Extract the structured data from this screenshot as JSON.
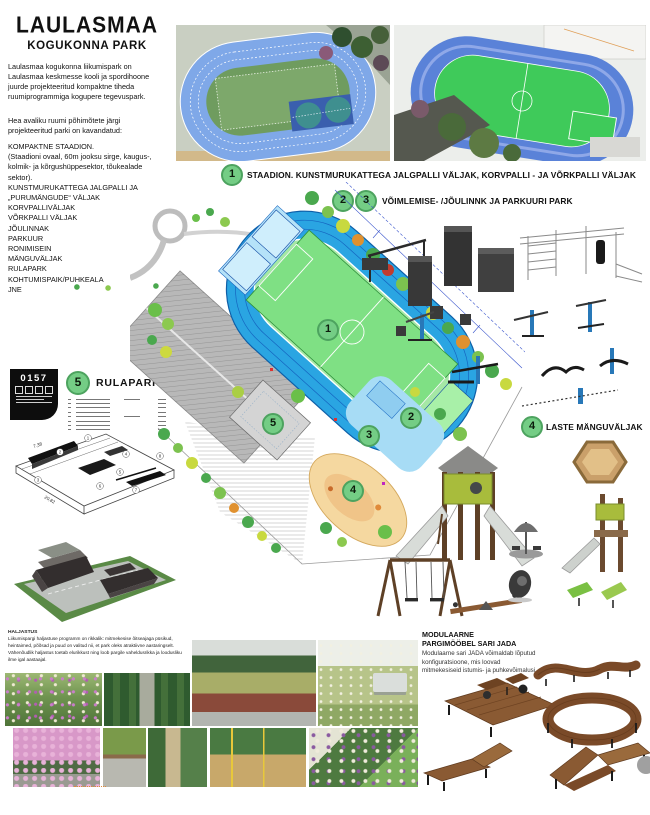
{
  "poster": {
    "title": "LAULASMAA",
    "subtitle": "KOGUKONNA PARK",
    "intro_p1": "Laulasmaa kogukonna liikumispark on Laulasmaa keskmesse kooli ja spordihoone juurde projekteeritud kompaktne tiheda ruumiprogrammiga kogupere tegevuspark.",
    "intro_p2": "Hea avaliku ruumi põhimõtete järgi projekteeritud parki on kavandatud:",
    "program_list": [
      "KOMPAKTNE STAADION.",
      "(Staadioni ovaal, 60m jooksu sirge, kaugus-, kolmik- ja kõrgushüppesektor, tõukealade sektor).",
      "KUNSTMURUKATTEGA JALGPALLI JA „PURUMÄNGUDE“ VÄLJAK",
      "KORVPALLIVÄLJAK",
      "VÕRKPALLI VÄLJAK",
      "JÕULINNAK",
      "PARKUUR",
      "RONIMISEIN",
      "MÄNGUVÄLJAK",
      "RULAPARK",
      "KOHTUMISPAIK/PUHKEALA",
      "JNE"
    ]
  },
  "badge": {
    "code": "0157"
  },
  "sections": {
    "s1": {
      "num": "1",
      "label": "STAADION. KUNSTMURUKATTEGA JALGPALLI VÄLJAK, KORVPALLI - JA VÕRKPALLI VÄLJAK"
    },
    "s23": {
      "num_a": "2",
      "num_b": "3",
      "label": "VÕIMLEMISE- /JÕULINNK JA PARKUURI PARK"
    },
    "s4": {
      "num": "4",
      "label": "LASTE MÄNGUVÄLJAK"
    },
    "s5": {
      "num": "5",
      "label": "RULAPARK"
    }
  },
  "plan_markers": [
    "1",
    "2",
    "3",
    "4",
    "5"
  ],
  "skate": {
    "dims": {
      "width": "7,38",
      "length": "20,82"
    },
    "callouts": [
      "1",
      "2",
      "3",
      "4",
      "5",
      "6",
      "7",
      "8"
    ]
  },
  "greening": {
    "title": "HALJASTUS",
    "body": "Liikumispargi haljastuse programm on rikkalik: mitmekesise õitseajaga püsikud, heintaimed, põõsad ja puud on valitud nii, et park oleks atraktiivne aastaringselt. Vähenõudlik haljastus toetab elurikkust ning loob pargile vaheldusrikka ja loodusliku ilme igal aastaajal."
  },
  "furniture": {
    "heading_line1": "MODULAARNE",
    "heading_line2": "PARGIMÖÖBEL SARI JADA",
    "body": "Modulaarne sari JADA võimaldab lõputud konfiguratsioone, mis loovad mitmekesiseid istumis- ja puhkevõimalusi."
  },
  "colors": {
    "marker_green": "#74cd85",
    "track_blue": "#2aa5e2",
    "field_green": "#8be48e",
    "sand": "#f5d8a0",
    "wood": "#8a5a33"
  }
}
